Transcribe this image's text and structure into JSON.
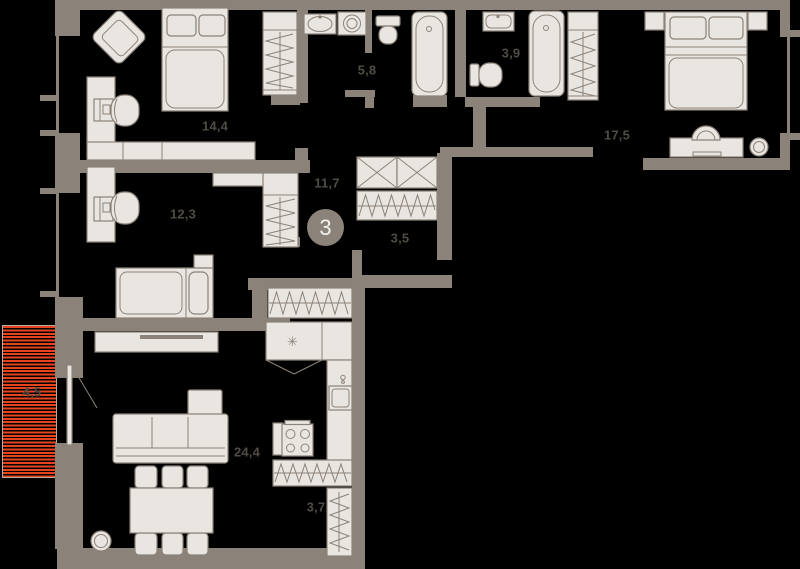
{
  "plan": {
    "apartment_number": "3",
    "rooms": [
      {
        "id": "bedroom-1",
        "area": "14,4"
      },
      {
        "id": "bedroom-2",
        "area": "12,3"
      },
      {
        "id": "bedroom-3",
        "area": "17,5"
      },
      {
        "id": "bathroom-1",
        "area": "5,8"
      },
      {
        "id": "bathroom-2",
        "area": "3,9"
      },
      {
        "id": "hallway",
        "area": "11,7"
      },
      {
        "id": "wardrobe",
        "area": "3,5"
      },
      {
        "id": "living-kitchen",
        "area": "24,4"
      },
      {
        "id": "closet",
        "area": "3,7"
      },
      {
        "id": "balcony",
        "area": "4,5"
      }
    ],
    "colors": {
      "wall": "#8b8279",
      "furniture": "#e9e6e1",
      "line": "#8b8279",
      "label": "#4f4b45",
      "balcony_red": "#e8431f",
      "badge_text": "#f4f2ef",
      "background": "#000000"
    }
  }
}
